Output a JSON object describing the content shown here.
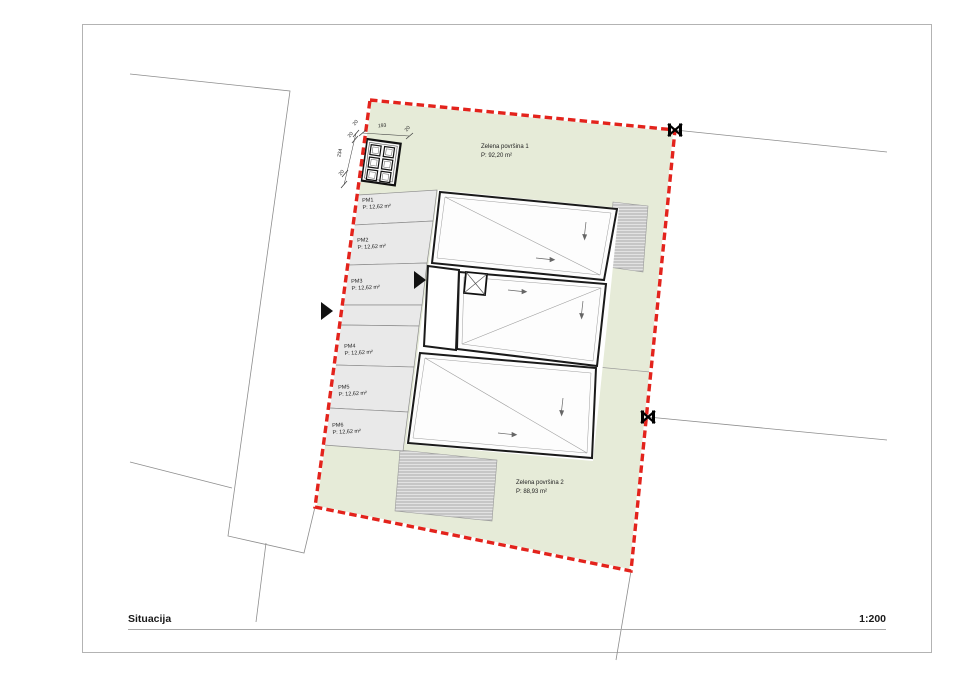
{
  "page": {
    "title": "Situacija",
    "scale": "1:200"
  },
  "site": {
    "colors": {
      "boundary_red": "#e3231c",
      "green_fill": "#e6ebd8",
      "parking_fill": "#e9e9e9",
      "building_fill": "#fdfdfd"
    },
    "green_areas": [
      {
        "name": "Zelena površina 1",
        "area": "P: 92,20 m²"
      },
      {
        "name": "Zelena površina 2",
        "area": "P: 88,93 m²"
      }
    ],
    "parking": {
      "stalls": [
        {
          "name": "PM1",
          "area": "P: 12,62 m²"
        },
        {
          "name": "PM2",
          "area": "P: 12,62 m²"
        },
        {
          "name": "PM3",
          "area": "P: 12,62 m²"
        },
        {
          "name": "PM4",
          "area": "P: 12,62 m²"
        },
        {
          "name": "PM5",
          "area": "P: 12,62 m²"
        },
        {
          "name": "PM6",
          "area": "P: 12,62 m²"
        }
      ]
    },
    "dimensions": {
      "top_chain": [
        "20",
        "193",
        "20"
      ],
      "left_chain": [
        "20",
        "234",
        "20"
      ]
    }
  }
}
